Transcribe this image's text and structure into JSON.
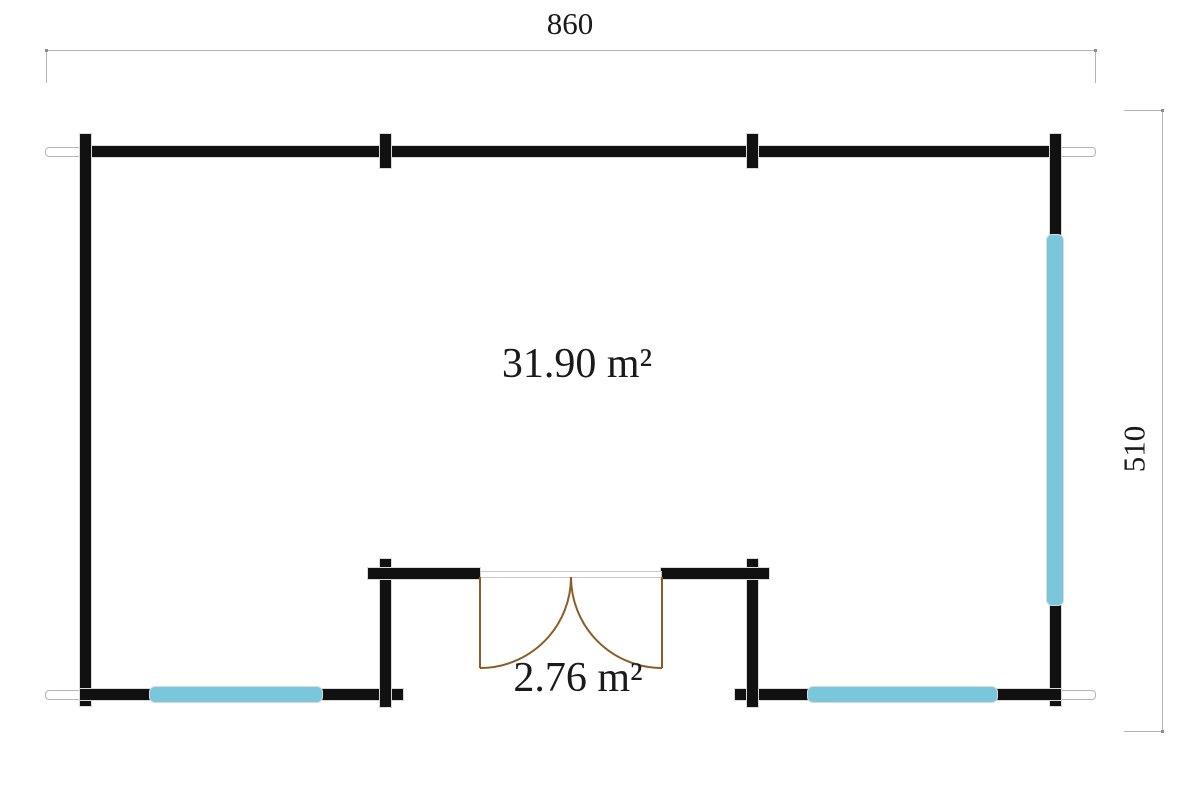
{
  "dimensions": {
    "width_label": "860",
    "depth_label": "510"
  },
  "rooms": {
    "main_area_label": "31.90 m²",
    "porch_area_label": "2.76 m²"
  },
  "colors": {
    "wall": "#111111",
    "window": "#7ac6da",
    "door": "#8b5e26",
    "dim": "#b3b3b3",
    "outline": "#dadada",
    "text": "#1a1a1a"
  }
}
